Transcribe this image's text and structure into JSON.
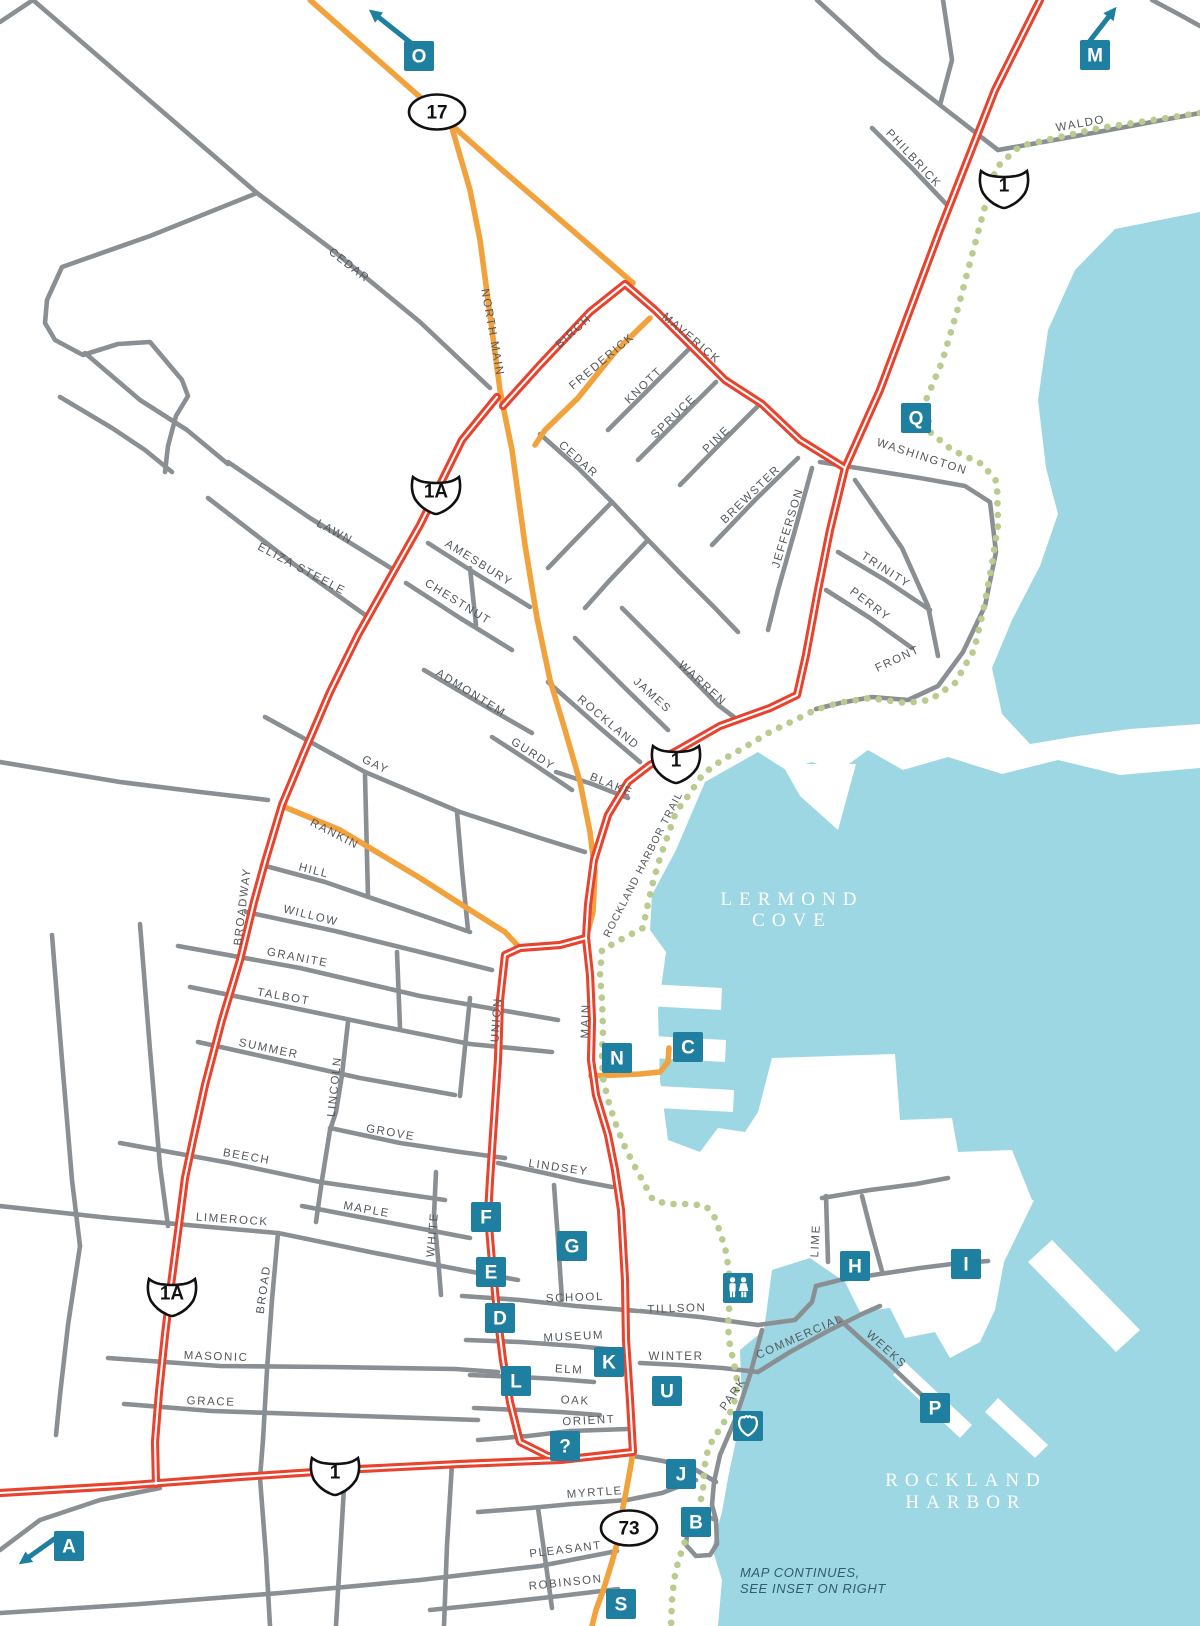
{
  "colors": {
    "water": "#9CD7E3",
    "land": "#FFFFFF",
    "road_minor": "#8A8F93",
    "road_highway_red": "#E8432E",
    "road_secondary_orange": "#F2A23C",
    "trail_green": "#BACB90",
    "marker_teal": "#1F7FA0",
    "street_label": "#54585C",
    "note_text": "#2F5D6E"
  },
  "water_labels": [
    {
      "id": "lermond-cove",
      "lines": [
        "LERMOND",
        "COVE"
      ],
      "x": 792,
      "y1": 905,
      "y2": 926
    },
    {
      "id": "rockland-harbor",
      "lines": [
        "ROCKLAND",
        "HARBOR"
      ],
      "x": 966,
      "y1": 1486,
      "y2": 1508
    }
  ],
  "note": {
    "line1": "MAP CONTINUES,",
    "line2": "SEE INSET ON RIGHT"
  },
  "route_shields": [
    {
      "type": "oval",
      "label": "17",
      "x": 437,
      "y": 112
    },
    {
      "type": "us",
      "label": "1",
      "x": 1004,
      "y": 185
    },
    {
      "type": "us",
      "label": "1A",
      "x": 436,
      "y": 491
    },
    {
      "type": "us",
      "label": "1",
      "x": 676,
      "y": 760
    },
    {
      "type": "us",
      "label": "1A",
      "x": 172,
      "y": 1293
    },
    {
      "type": "us",
      "label": "1",
      "x": 335,
      "y": 1472
    },
    {
      "type": "oval",
      "label": "73",
      "x": 629,
      "y": 1528
    }
  ],
  "markers": [
    {
      "label": "O",
      "x": 419,
      "y": 56,
      "arrow": "nw"
    },
    {
      "label": "M",
      "x": 1095,
      "y": 55,
      "arrow": "ne"
    },
    {
      "label": "Q",
      "x": 916,
      "y": 418
    },
    {
      "label": "N",
      "x": 617,
      "y": 1058
    },
    {
      "label": "C",
      "x": 688,
      "y": 1047
    },
    {
      "label": "F",
      "x": 486,
      "y": 1217
    },
    {
      "label": "G",
      "x": 572,
      "y": 1246
    },
    {
      "label": "E",
      "x": 491,
      "y": 1272
    },
    {
      "label": "D",
      "x": 500,
      "y": 1318
    },
    {
      "label": "L",
      "x": 516,
      "y": 1381
    },
    {
      "label": "K",
      "x": 609,
      "y": 1362
    },
    {
      "label": "U",
      "x": 667,
      "y": 1391
    },
    {
      "label": "?",
      "x": 565,
      "y": 1446
    },
    {
      "label": "J",
      "x": 681,
      "y": 1474
    },
    {
      "label": "B",
      "x": 696,
      "y": 1522
    },
    {
      "label": "S",
      "x": 621,
      "y": 1604
    },
    {
      "label": "H",
      "x": 855,
      "y": 1266
    },
    {
      "label": "I",
      "x": 966,
      "y": 1264
    },
    {
      "label": "P",
      "x": 935,
      "y": 1408
    },
    {
      "label": "A",
      "x": 69,
      "y": 1546,
      "arrow": "sw"
    }
  ],
  "poi_icons": [
    {
      "id": "restroom",
      "x": 738,
      "y": 1288
    },
    {
      "id": "landmark-shield",
      "x": 748,
      "y": 1426
    }
  ],
  "street_labels": [
    {
      "t": "CEDAR",
      "x": 347,
      "y": 268,
      "r": 38
    },
    {
      "t": "NORTH MAIN",
      "x": 489,
      "y": 333,
      "r": 80
    },
    {
      "t": "BIRCH",
      "x": 576,
      "y": 334,
      "r": -42
    },
    {
      "t": "FREDERICK",
      "x": 604,
      "y": 364,
      "r": -40
    },
    {
      "t": "MAVERICK",
      "x": 689,
      "y": 341,
      "r": 40
    },
    {
      "t": "KNOTT",
      "x": 646,
      "y": 388,
      "r": -44
    },
    {
      "t": "SPRUCE",
      "x": 676,
      "y": 419,
      "r": -44
    },
    {
      "t": "PINE",
      "x": 719,
      "y": 442,
      "r": -44
    },
    {
      "t": "CEDAR",
      "x": 576,
      "y": 462,
      "r": 42
    },
    {
      "t": "BREWSTER",
      "x": 753,
      "y": 497,
      "r": -44
    },
    {
      "t": "JEFFERSON",
      "x": 791,
      "y": 529,
      "r": -73
    },
    {
      "t": "WASHINGTON",
      "x": 921,
      "y": 460,
      "r": 18
    },
    {
      "t": "TRINITY",
      "x": 884,
      "y": 573,
      "r": 33
    },
    {
      "t": "PERRY",
      "x": 868,
      "y": 607,
      "r": 37
    },
    {
      "t": "FRONT",
      "x": 899,
      "y": 662,
      "r": -25
    },
    {
      "t": "PHILBRICK",
      "x": 911,
      "y": 161,
      "r": 47
    },
    {
      "t": "WALDO",
      "x": 1081,
      "y": 127,
      "r": -10
    },
    {
      "t": "LAWN",
      "x": 333,
      "y": 535,
      "r": 28
    },
    {
      "t": "ELIZA STEELE",
      "x": 300,
      "y": 572,
      "r": 28
    },
    {
      "t": "AMESBURY",
      "x": 477,
      "y": 566,
      "r": 32
    },
    {
      "t": "CHESTNUT",
      "x": 456,
      "y": 605,
      "r": 32
    },
    {
      "t": "ADMONTEM",
      "x": 469,
      "y": 696,
      "r": 32
    },
    {
      "t": "ROCKLAND",
      "x": 606,
      "y": 725,
      "r": 40
    },
    {
      "t": "GURDY",
      "x": 531,
      "y": 757,
      "r": 33
    },
    {
      "t": "JAMES",
      "x": 650,
      "y": 698,
      "r": 42
    },
    {
      "t": "WARREN",
      "x": 700,
      "y": 686,
      "r": 42
    },
    {
      "t": "BLAKE",
      "x": 610,
      "y": 788,
      "r": 22
    },
    {
      "t": "ROCKLAND HARBOR TRAIL",
      "x": 646,
      "y": 866,
      "r": -63,
      "s": 10.5
    },
    {
      "t": "GAY",
      "x": 374,
      "y": 768,
      "r": 25
    },
    {
      "t": "RANKIN",
      "x": 333,
      "y": 837,
      "r": 27
    },
    {
      "t": "HILL",
      "x": 313,
      "y": 874,
      "r": 14
    },
    {
      "t": "WILLOW",
      "x": 310,
      "y": 919,
      "r": 14
    },
    {
      "t": "GRANITE",
      "x": 297,
      "y": 961,
      "r": 11
    },
    {
      "t": "TALBOT",
      "x": 283,
      "y": 1000,
      "r": 10
    },
    {
      "t": "BROADWAY",
      "x": 246,
      "y": 907,
      "r": -83
    },
    {
      "t": "SUMMER",
      "x": 268,
      "y": 1052,
      "r": 12
    },
    {
      "t": "LINCOLN",
      "x": 338,
      "y": 1087,
      "r": -84
    },
    {
      "t": "GROVE",
      "x": 390,
      "y": 1136,
      "r": 10
    },
    {
      "t": "BEECH",
      "x": 246,
      "y": 1160,
      "r": 10
    },
    {
      "t": "MAPLE",
      "x": 366,
      "y": 1213,
      "r": 10
    },
    {
      "t": "WHITE",
      "x": 436,
      "y": 1235,
      "r": -85
    },
    {
      "t": "LIMEROCK",
      "x": 232,
      "y": 1223,
      "r": 4
    },
    {
      "t": "BROAD",
      "x": 267,
      "y": 1290,
      "r": -82
    },
    {
      "t": "MASONIC",
      "x": 216,
      "y": 1360,
      "r": 2
    },
    {
      "t": "GRACE",
      "x": 211,
      "y": 1405,
      "r": 2
    },
    {
      "t": "LINDSEY",
      "x": 558,
      "y": 1171,
      "r": 8
    },
    {
      "t": "SCHOOL",
      "x": 575,
      "y": 1301,
      "r": -2
    },
    {
      "t": "TILLSON",
      "x": 677,
      "y": 1312,
      "r": -2
    },
    {
      "t": "MUSEUM",
      "x": 574,
      "y": 1340,
      "r": -3
    },
    {
      "t": "WINTER",
      "x": 676,
      "y": 1360,
      "r": 0
    },
    {
      "t": "ELM",
      "x": 569,
      "y": 1373,
      "r": 3
    },
    {
      "t": "OAK",
      "x": 575,
      "y": 1404,
      "r": 3
    },
    {
      "t": "ORIENT",
      "x": 589,
      "y": 1424,
      "r": -3
    },
    {
      "t": "MYRTLE",
      "x": 595,
      "y": 1496,
      "r": -4
    },
    {
      "t": "PLEASANT",
      "x": 566,
      "y": 1553,
      "r": -7
    },
    {
      "t": "ROBINSON",
      "x": 566,
      "y": 1586,
      "r": -6
    },
    {
      "t": "COMMERCIAL",
      "x": 801,
      "y": 1340,
      "r": -24
    },
    {
      "t": "PARK",
      "x": 736,
      "y": 1396,
      "r": -55
    },
    {
      "t": "LIME",
      "x": 819,
      "y": 1241,
      "r": -87
    },
    {
      "t": "WEEKS",
      "x": 884,
      "y": 1352,
      "r": 42
    },
    {
      "t": "UNION",
      "x": 500,
      "y": 1020,
      "r": -86
    },
    {
      "t": "MAIN",
      "x": 589,
      "y": 1021,
      "r": -88
    }
  ]
}
